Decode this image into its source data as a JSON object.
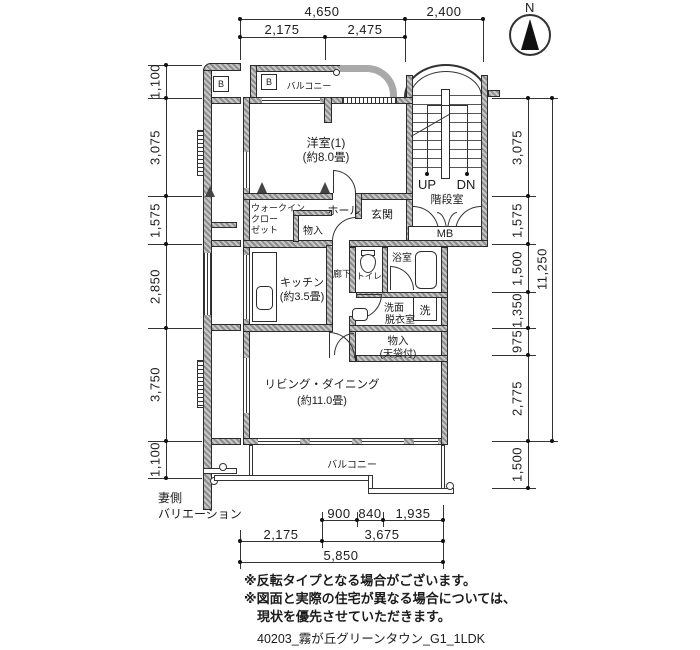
{
  "caption": "40203_霧が丘グリーンタウン_G1_1LDK",
  "notes": {
    "line1": "※反転タイプとなる場合がございます。",
    "line2": "※図面と実際の住宅が異なる場合については、",
    "line3": "現状を優先させていただきます。"
  },
  "side_label": {
    "line1": "妻側",
    "line2": "バリエーション"
  },
  "compass": {
    "north": "N"
  },
  "markers": {
    "balcony_b": "B",
    "side_b": "B"
  },
  "rooms": {
    "bedroom": "洋室(1)",
    "bedroom_size": "(約8.0畳)",
    "wic_line1": "ウォークイン",
    "wic_line2": "クロー",
    "wic_line3": "ゼット",
    "closet_hall": "物入",
    "hall": "ホール",
    "entrance": "玄関",
    "stair_room": "階段室",
    "stair_up": "UP",
    "stair_dn": "DN",
    "meter_box": "MB",
    "corridor": "廊下",
    "toilet": "トイレ",
    "bath": "浴室",
    "kitchen": "キッチン",
    "kitchen_size": "(約3.5畳)",
    "washroom_line1": "洗面",
    "washroom_line2": "脱衣室",
    "washer": "洗",
    "closet_living_line1": "物入",
    "closet_living_line2": "(天袋付)",
    "living": "リビング・ダイニング",
    "living_size": "(約11.0畳)",
    "balcony_top": "バルコニー",
    "balcony_bottom": "バルコニー"
  },
  "dims": {
    "top": {
      "w4650": "4,650",
      "w2400": "2,400",
      "w2175": "2,175",
      "w2475": "2,475"
    },
    "left": {
      "s1": "1,100",
      "s2": "3,075",
      "s3": "1,575",
      "s4": "2,850",
      "s5": "3,750",
      "s6": "1,100"
    },
    "right": {
      "s1": "3,075",
      "s2": "1,575",
      "s3": "1,500",
      "s4": "1,350",
      "s5": "975",
      "s6": "2,775",
      "s7": "1,500",
      "total": "11,250"
    },
    "bottom": {
      "s900": "900",
      "s840": "840",
      "s1935": "1,935",
      "s2175": "2,175",
      "s3675": "3,675",
      "s5850": "5,850"
    }
  },
  "colors": {
    "ink": "#1c1c1c",
    "wall_gray": "#9a9a9a"
  }
}
